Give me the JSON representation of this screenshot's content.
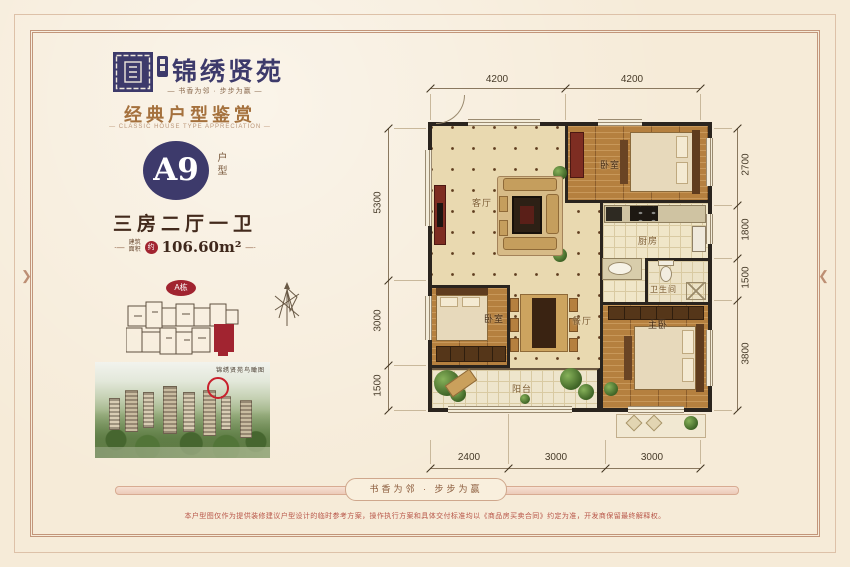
{
  "brand": {
    "name": "锦绣贤苑",
    "tagline": "— 书香为邻 · 步步为赢 —"
  },
  "header": {
    "title": "经典户型鉴赏",
    "subtitle": "—  CLASSIC HOUSE TYPE APPRECIATION  —"
  },
  "unit": {
    "code": "A9",
    "code_label": "户型",
    "rooms_summary": "三房二厅一卫",
    "area_deco_left": "·—",
    "area_label_line1": "建筑",
    "area_label_line2": "面积",
    "area_approx": "约",
    "area_value": "106.60m²",
    "area_deco_right": "—·"
  },
  "keyplan": {
    "badge": "A栋"
  },
  "aerial": {
    "caption": "锦绣贤苑鸟瞰图"
  },
  "floorplan": {
    "rooms": {
      "living": "客厅",
      "bedroom_top": "卧室",
      "kitchen": "厨房",
      "bathroom": "卫生间",
      "dining": "餐厅",
      "bedroom_left": "卧室",
      "balcony": "阳台",
      "master": "主卧"
    },
    "dims_top": [
      "4200",
      "4200"
    ],
    "dims_left": [
      "5300",
      "3000",
      "1500"
    ],
    "dims_right": [
      "2700",
      "1800",
      "1500",
      "3800"
    ],
    "dims_bottom": [
      "2400",
      "3000",
      "3000"
    ]
  },
  "footer": {
    "ribbon": "书香为邻 · 步步为赢",
    "disclaimer": "本户型图仅作为提供装修建议户型设计的临时参考方案，操作执行方案和具体交付标准均以《商品房买卖合同》约定为准，开发商保留最终解释权。"
  },
  "icons": {
    "chevron_right": "❯",
    "chevron_left": "❮"
  },
  "colors": {
    "navy": "#3d3a6b",
    "red": "#a12430",
    "bronze": "#a5713d",
    "ink": "#432a1c"
  }
}
